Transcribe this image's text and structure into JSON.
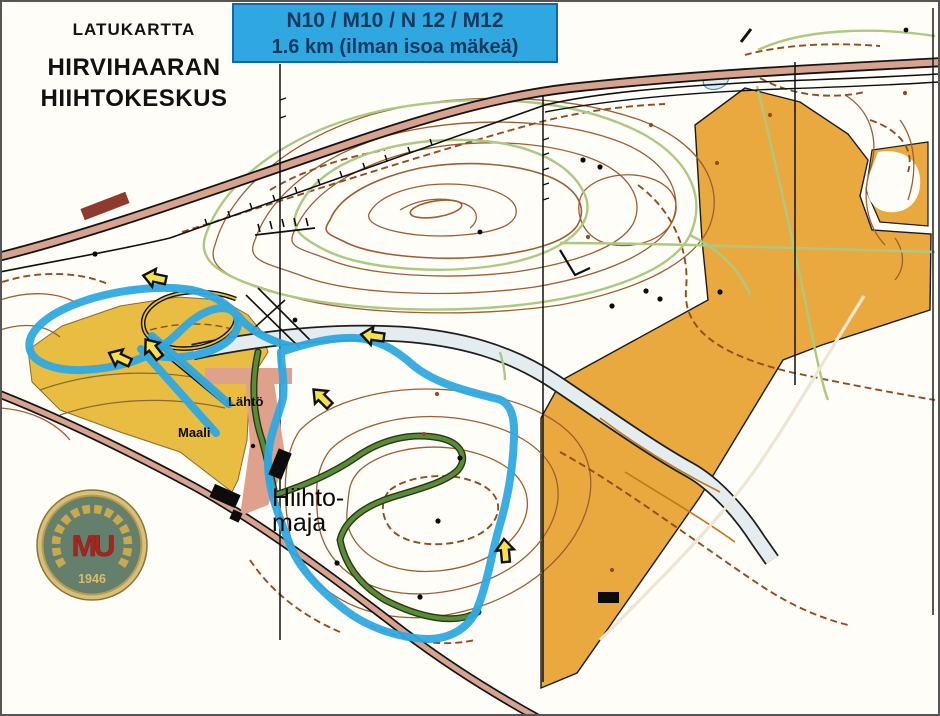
{
  "header": {
    "kicker": "LATUKARTTA",
    "title_line1": "HIRVIHAARAN",
    "title_line2": "HIIHTOKESKUS"
  },
  "banner": {
    "line1": "N10 / M10 / N 12 / M12",
    "line2": "1.6 km (ilman isoa mäkeä)",
    "background": "#2fa8e1",
    "border": "#1565a8",
    "text_color": "#16395e"
  },
  "map": {
    "labels": {
      "start": "Lähtö",
      "finish": "Maali",
      "hut1": "Hiihto-",
      "hut2": "maja"
    }
  },
  "logo": {
    "monogram": "MU",
    "year": "1946",
    "disc_color": "#647f6c",
    "ring_color": "#c8a94e",
    "monogram_color": "#a6261e"
  },
  "colors": {
    "course_blue": "#2fa9e1",
    "field_orange": "#eaa93e",
    "stadium_yellow": "#e9bc42",
    "road_fill": "#d8a38e",
    "contour_brown": "#9c5f33",
    "path_brown": "#8f4e1f",
    "trail_light_green": "#adc981",
    "course_trail_green": "#5b8a38",
    "water_blue": "#e3edf0",
    "arrow_yellow": "#f6e14d",
    "corridor_pink": "#e0a18c",
    "dark_red_patch": "#8e3a2c"
  }
}
